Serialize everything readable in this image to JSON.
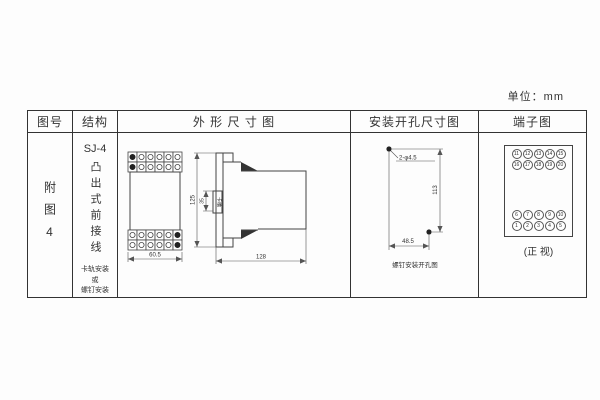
{
  "unit_label": "单位：mm",
  "table": {
    "headers": {
      "figure_no": "图号",
      "structure": "结构",
      "outline": "外 形 尺 寸 图",
      "mounting": "安装开孔尺寸图",
      "terminal": "端子图"
    },
    "row": {
      "figure_no": "附图4",
      "structure": {
        "model": "SJ-4",
        "type_vertical": "凸出式前接线",
        "mount_note": "卡轨安装\n或\n螺钉安装"
      }
    }
  },
  "outline_drawing": {
    "front_width": "60.5",
    "height": "125",
    "rail_dim": "35",
    "rail_label": "卡槽",
    "depth": "128"
  },
  "mounting_drawing": {
    "holes_label": "2-φ4.5",
    "height": "113",
    "width": "48.5",
    "caption": "螺钉安装开孔图"
  },
  "terminal_diagram": {
    "top_rows": [
      [
        11,
        12,
        13,
        14,
        15
      ],
      [
        16,
        17,
        18,
        19,
        20
      ]
    ],
    "bottom_rows": [
      [
        6,
        7,
        8,
        9,
        10
      ],
      [
        1,
        2,
        3,
        4,
        5
      ]
    ],
    "caption": "(正 视)"
  },
  "colors": {
    "line": "#444444",
    "text": "#333333",
    "background": "#fdfdfd"
  }
}
